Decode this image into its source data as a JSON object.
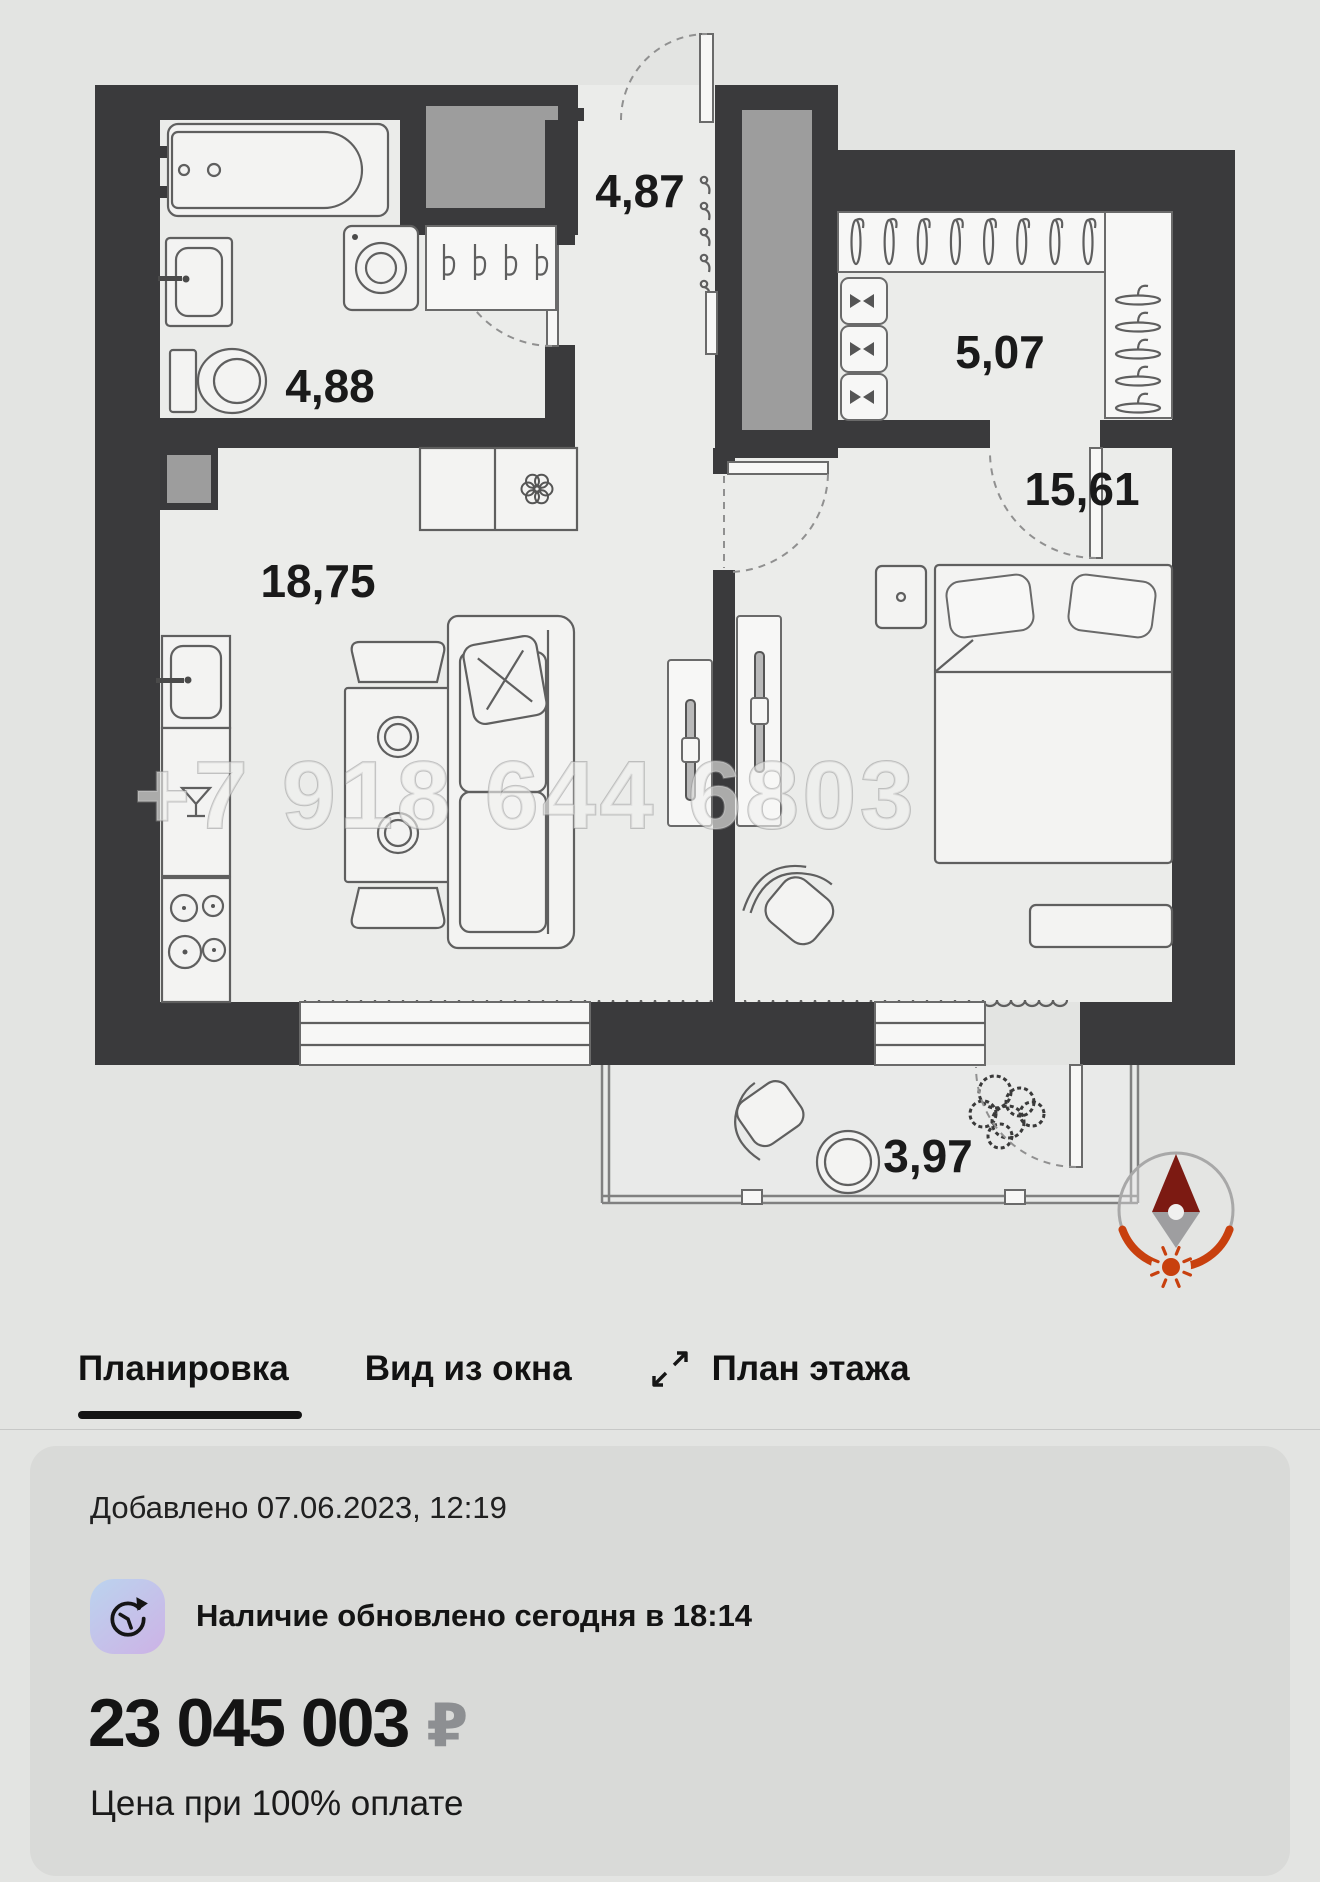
{
  "floor_plan": {
    "watermark": "+7 918 644 6803",
    "rooms": {
      "hall": "4,87",
      "bathroom": "4,88",
      "wardrobe": "5,07",
      "bedroom": "15,61",
      "kitchen_living": "18,75",
      "balcony": "3,97"
    },
    "colors": {
      "walls": "#3a3a3c",
      "shaft_fill": "#9d9d9d",
      "compass_red": "#c8400e",
      "compass_dark_red": "#7c1a12",
      "compass_gray": "#9e9ea0"
    }
  },
  "tabs": {
    "items": [
      {
        "label": "Планировка"
      },
      {
        "label": "Вид из окна"
      },
      {
        "label": "План этажа"
      }
    ],
    "active": "Планировка"
  },
  "listing": {
    "added": "Добавлено 07.06.2023, 12:19",
    "availability": "Наличие обновлено сегодня в 18:14",
    "price": "23 045 003",
    "currency": "₽",
    "price_note": "Цена при 100% оплате"
  }
}
